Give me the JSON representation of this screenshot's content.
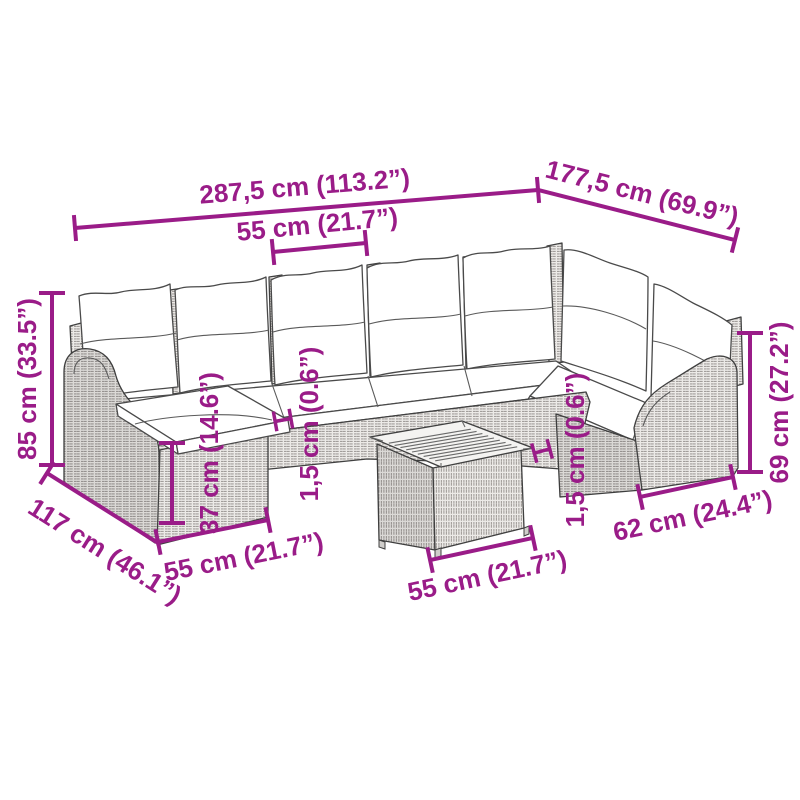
{
  "colors": {
    "accent": "#9a1c88",
    "outline": "#404040",
    "wicker_fill": "#eceae7",
    "cushion": "#ffffff",
    "wood_top": "#f4f3f1"
  },
  "dims": {
    "overall_width": "287,5 cm (113.2”)",
    "overall_depth": "177,5 cm (69.9”)",
    "seat_width_top": "55 cm (21.7”)",
    "total_height": "85 cm (33.5”)",
    "chaise_depth": "117 cm (46.1”)",
    "front_height": "37 cm (14.6”)",
    "front_width": "55 cm (21.7”)",
    "table_width": "55 cm (21.7”)",
    "right_seat_width": "62 cm (24.4”)",
    "right_side_height": "69 cm (27.2”)",
    "cushion_gap_left": "1,5 cm (0.6”)",
    "cushion_gap_right": "1,5 cm (0.6”)"
  }
}
